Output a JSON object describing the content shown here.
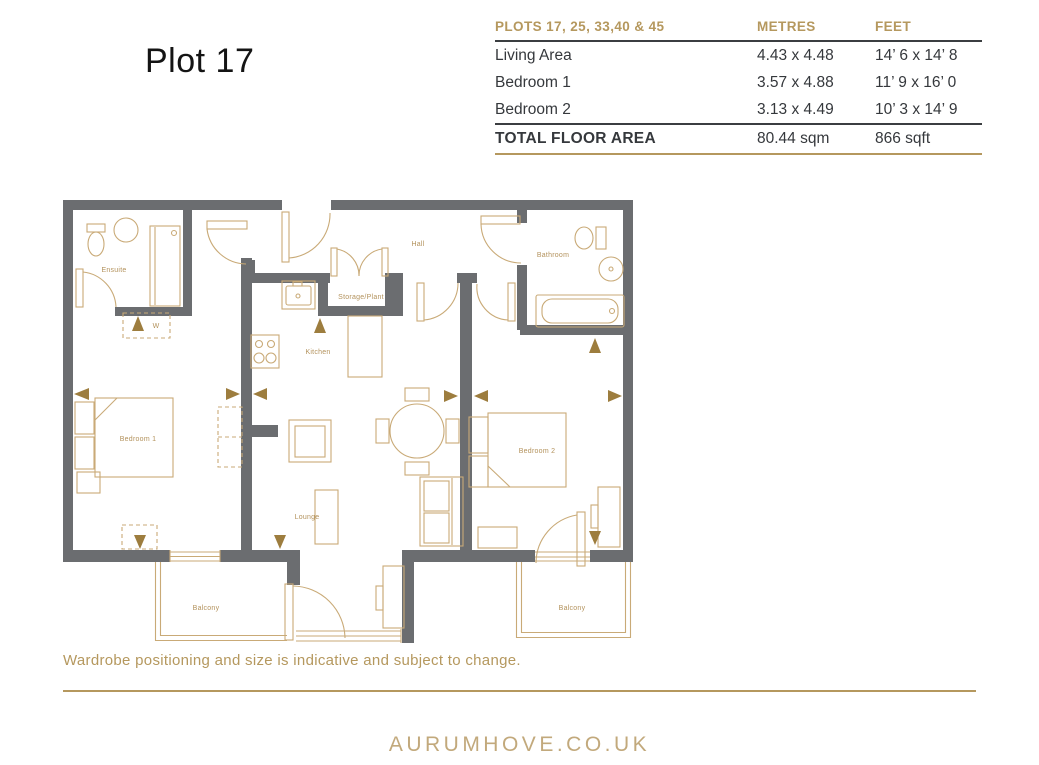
{
  "page": {
    "title": "Plot 17"
  },
  "spec_table": {
    "header": {
      "plots": "PLOTS 17, 25, 33,40 & 45",
      "metres": "METRES",
      "feet": "FEET"
    },
    "rows": [
      {
        "label": "Living Area",
        "metres": "4.43 x 4.48",
        "feet": "14’ 6 x 14’ 8"
      },
      {
        "label": "Bedroom 1",
        "metres": "3.57 x 4.88",
        "feet": "11’ 9 x 16’ 0"
      },
      {
        "label": "Bedroom 2",
        "metres": "3.13 x 4.49",
        "feet": "10’ 3 x 14’ 9"
      }
    ],
    "total": {
      "label": "TOTAL FLOOR AREA",
      "metres": "80.44 sqm",
      "feet": "866 sqft"
    }
  },
  "plan": {
    "labels": {
      "ensuite": "Ensuite",
      "wardrobe": "W",
      "hall": "Hall",
      "storage_plant": "Storage/Plant",
      "kitchen": "Kitchen",
      "bathroom": "Bathroom",
      "bedroom1": "Bedroom 1",
      "bedroom2": "Bedroom 2",
      "lounge": "Lounge",
      "balcony_left": "Balcony",
      "balcony_right": "Balcony"
    }
  },
  "note": "Wardrobe positioning and size is indicative and subject to change.",
  "footer": {
    "website": "AURUMHOVE.CO.UK"
  },
  "colors": {
    "gold": "#b5985e",
    "wall_grey": "#6b6d70",
    "plan_line": "#c9aa77",
    "dark_text": "#35383c",
    "arrow_gold": "#9d7d3e"
  }
}
